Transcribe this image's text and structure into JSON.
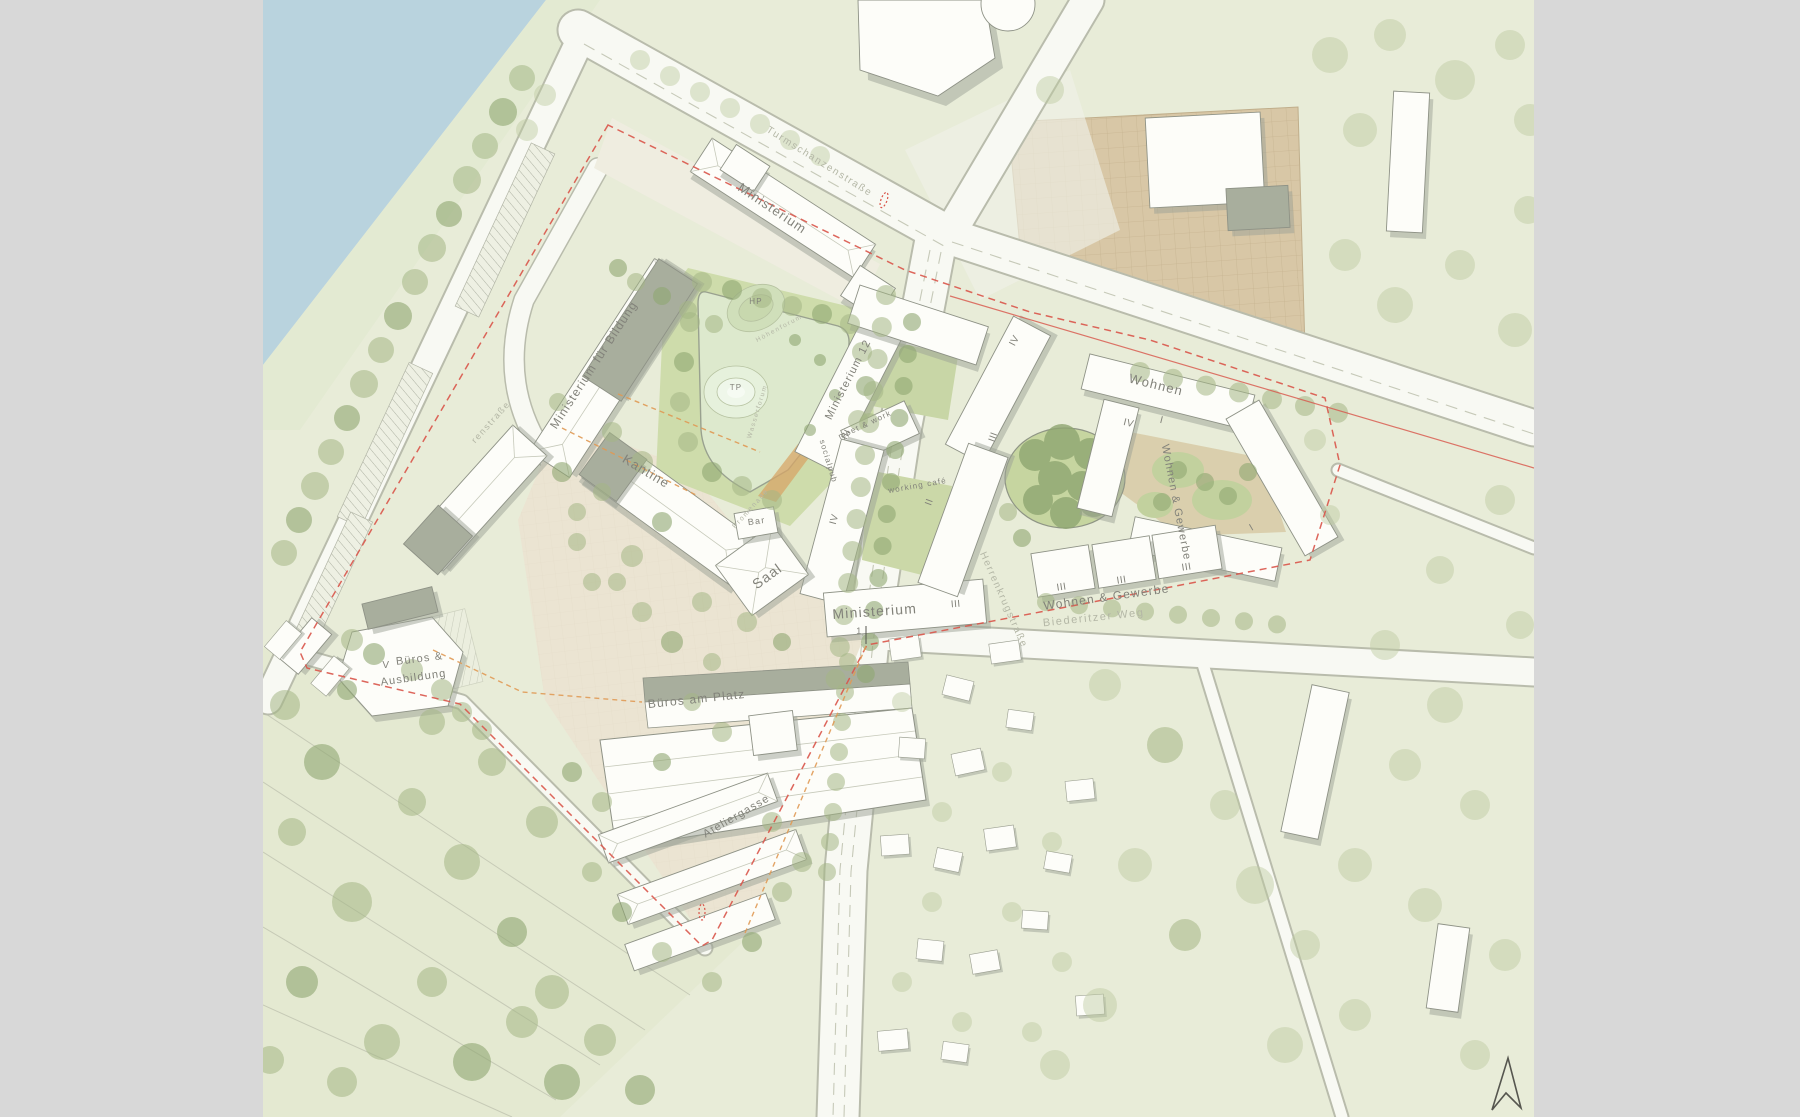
{
  "map": {
    "labels": {
      "ministerium_top": "Ministerium",
      "ministerium_fuer_bildung": "Ministerium für Bildung",
      "kantine": "Kantine",
      "ministerium_12": "Ministerium 12",
      "meet_work": "meet & work",
      "socialpub": "socialpub",
      "working_cafe": "working café",
      "bar": "Bar",
      "saal": "Saal",
      "ministerium_center": "Ministerium",
      "promenade": "Promenade",
      "hp": "HP",
      "tp": "TP",
      "hoehenforum": "Höhenforum",
      "wasserforum": "Wasserforum",
      "bueros_line1": "Büros &",
      "bueros_line2": "Ausbildung",
      "bueros_am_platz": "Büros am Platz",
      "ateliergasse": "Ateliergasse",
      "wohnen": "Wohnen",
      "wohnen_gewerbe_vertical": "Wohnen & Gewerbe",
      "wohnen_gewerbe": "Wohnen & Gewerbe"
    },
    "streets": {
      "herrenkrugstrasse": "Herrenkrugstraße",
      "biederitzer_weg": "Biederitzer Weg",
      "turmschanzenstrasse": "Turmschanzenstraße",
      "renstrasse": "renstraße"
    },
    "numerals": {
      "iv_ne": "IV",
      "iii_a": "III",
      "ii_b": "II",
      "iii_b": "III",
      "iv_w": "IV",
      "iii_s": "III",
      "v_sw": "V",
      "iv_r": "IV",
      "i_r": "I",
      "i_e": "I",
      "iii_r1": "III",
      "iii_r2": "III",
      "iii_r3": "III",
      "section_1": "1"
    },
    "palette": {
      "background": "#d8d8d8",
      "map_base": "#e8ecd8",
      "water": "#b9d3de",
      "road": "#f8f9f3",
      "building": "#fdfdf9",
      "roof_gray": "#a8ae9d",
      "park": "#cedcab",
      "pond": "#dde9cd",
      "plaza": "#ebe4d2",
      "field_tan": "#d8c7a6",
      "tree": "#a4b685",
      "boundary_red": "#d9554a",
      "accent_orange": "#e09a55",
      "label": "#82827a"
    },
    "icons": {
      "north_arrow": "north-arrow-icon"
    }
  }
}
